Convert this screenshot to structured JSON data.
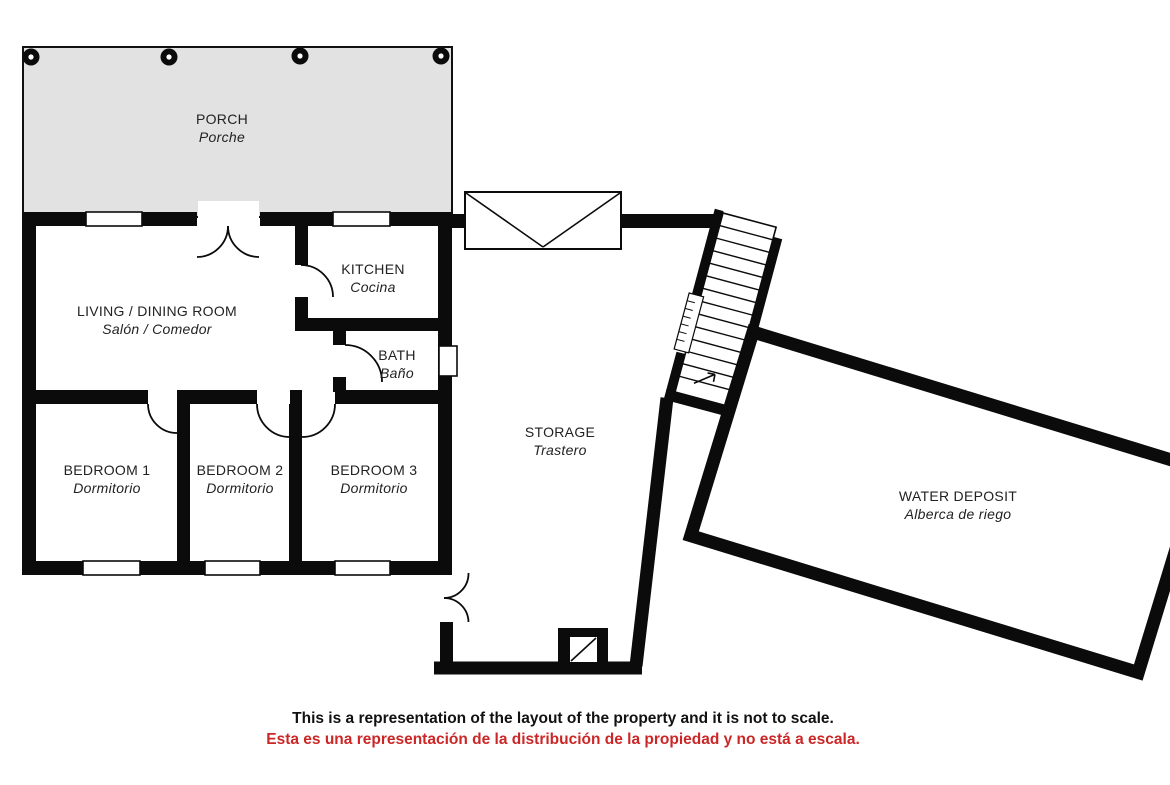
{
  "rooms": {
    "porch": {
      "en": "PORCH",
      "es": "Porche"
    },
    "living": {
      "en": "LIVING / DINING ROOM",
      "es": "Salón / Comedor"
    },
    "kitchen": {
      "en": "KITCHEN",
      "es": "Cocina"
    },
    "bath": {
      "en": "BATH",
      "es": "Baño"
    },
    "bedroom1": {
      "en": "BEDROOM 1",
      "es": "Dormitorio"
    },
    "bedroom2": {
      "en": "BEDROOM 2",
      "es": "Dormitorio"
    },
    "bedroom3": {
      "en": "BEDROOM 3",
      "es": "Dormitorio"
    },
    "storage": {
      "en": "STORAGE",
      "es": "Trastero"
    },
    "water_deposit": {
      "en": "WATER DEPOSIT",
      "es": "Alberca de riego"
    }
  },
  "disclaimer": {
    "en": "This is a representation of the layout of the property and it is not to scale.",
    "es": "Esta es una representación de la distribución de la propiedad y no está a escala."
  },
  "colors": {
    "wall": "#0b0b0b",
    "porch_fill": "#e2e2e2",
    "disclaimer_red": "#cb2727",
    "label_text": "#222222"
  }
}
